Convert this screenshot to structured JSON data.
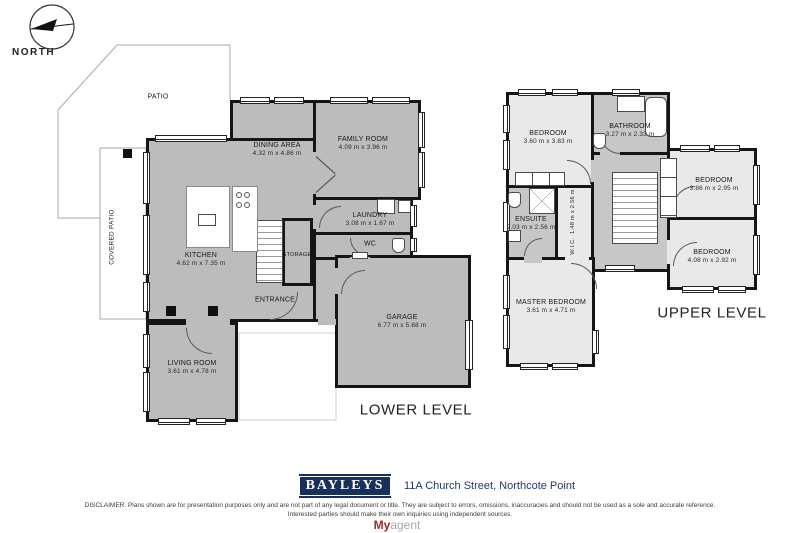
{
  "compass": {
    "label": "NORTH",
    "icon": "north-arrow-icon"
  },
  "levels": {
    "lower": {
      "title": "LOWER LEVEL",
      "rooms": [
        {
          "name": "PATIO"
        },
        {
          "name": "COVERED PATIO"
        },
        {
          "name": "DINING AREA",
          "dims": "4.32 m x 4.86 m"
        },
        {
          "name": "FAMILY ROOM",
          "dims": "4.09 m x 3.96 m"
        },
        {
          "name": "LAUNDRY",
          "dims": "3.08 m x 1.67 m"
        },
        {
          "name": "WC"
        },
        {
          "name": "KITCHEN",
          "dims": "4.62 m x 7.35 m"
        },
        {
          "name": "STORAGE"
        },
        {
          "name": "ENTRANCE"
        },
        {
          "name": "GARAGE",
          "dims": "6.77 m x 5.68 m"
        },
        {
          "name": "LIVING ROOM",
          "dims": "3.61 m x 4.78 m"
        }
      ]
    },
    "upper": {
      "title": "UPPER LEVEL",
      "rooms": [
        {
          "name": "BEDROOM",
          "dims": "3.60 m x 3.83 m"
        },
        {
          "name": "BATHROOM",
          "dims": "3.27 m x 2.33 m"
        },
        {
          "name": "ENSUITE",
          "dims": "2.03 m x 2.56 m"
        },
        {
          "name": "W.I.C.",
          "dims": "1.48 m x 2.56 m"
        },
        {
          "name": "BEDROOM",
          "dims": "3.86 m x 2.95 m"
        },
        {
          "name": "BEDROOM",
          "dims": "4.08 m x 2.92 m"
        },
        {
          "name": "MASTER BEDROOM",
          "dims": "3.61 m x 4.71 m"
        }
      ]
    }
  },
  "fixtures": [
    "stairs",
    "bathtub",
    "shower",
    "toilet",
    "sink",
    "vanity",
    "cooktop",
    "kitchen-island",
    "washer",
    "wardrobe",
    "garage-door"
  ],
  "footer": {
    "brand": "BAYLEYS",
    "address": "11A Church Street, Northcote Point",
    "disclaimer": "DISCLAIMER: Plans shown are for presentation purposes only and are not part of any legal document or title. They are subject to errors, omissions, inaccuracies and should not be used as a sole and accurate reference. Interested parties should make their own inquiries using independent sources.",
    "watermark_bold": "My",
    "watermark_rest": "agent"
  },
  "colors": {
    "wall": "#151515",
    "floor_gray": "#bcbcbc",
    "floor_light": "#e9e9e9",
    "floor_mid": "#c7c7c7",
    "brand_navy": "#18305c",
    "watermark_red": "#9e2b25"
  }
}
